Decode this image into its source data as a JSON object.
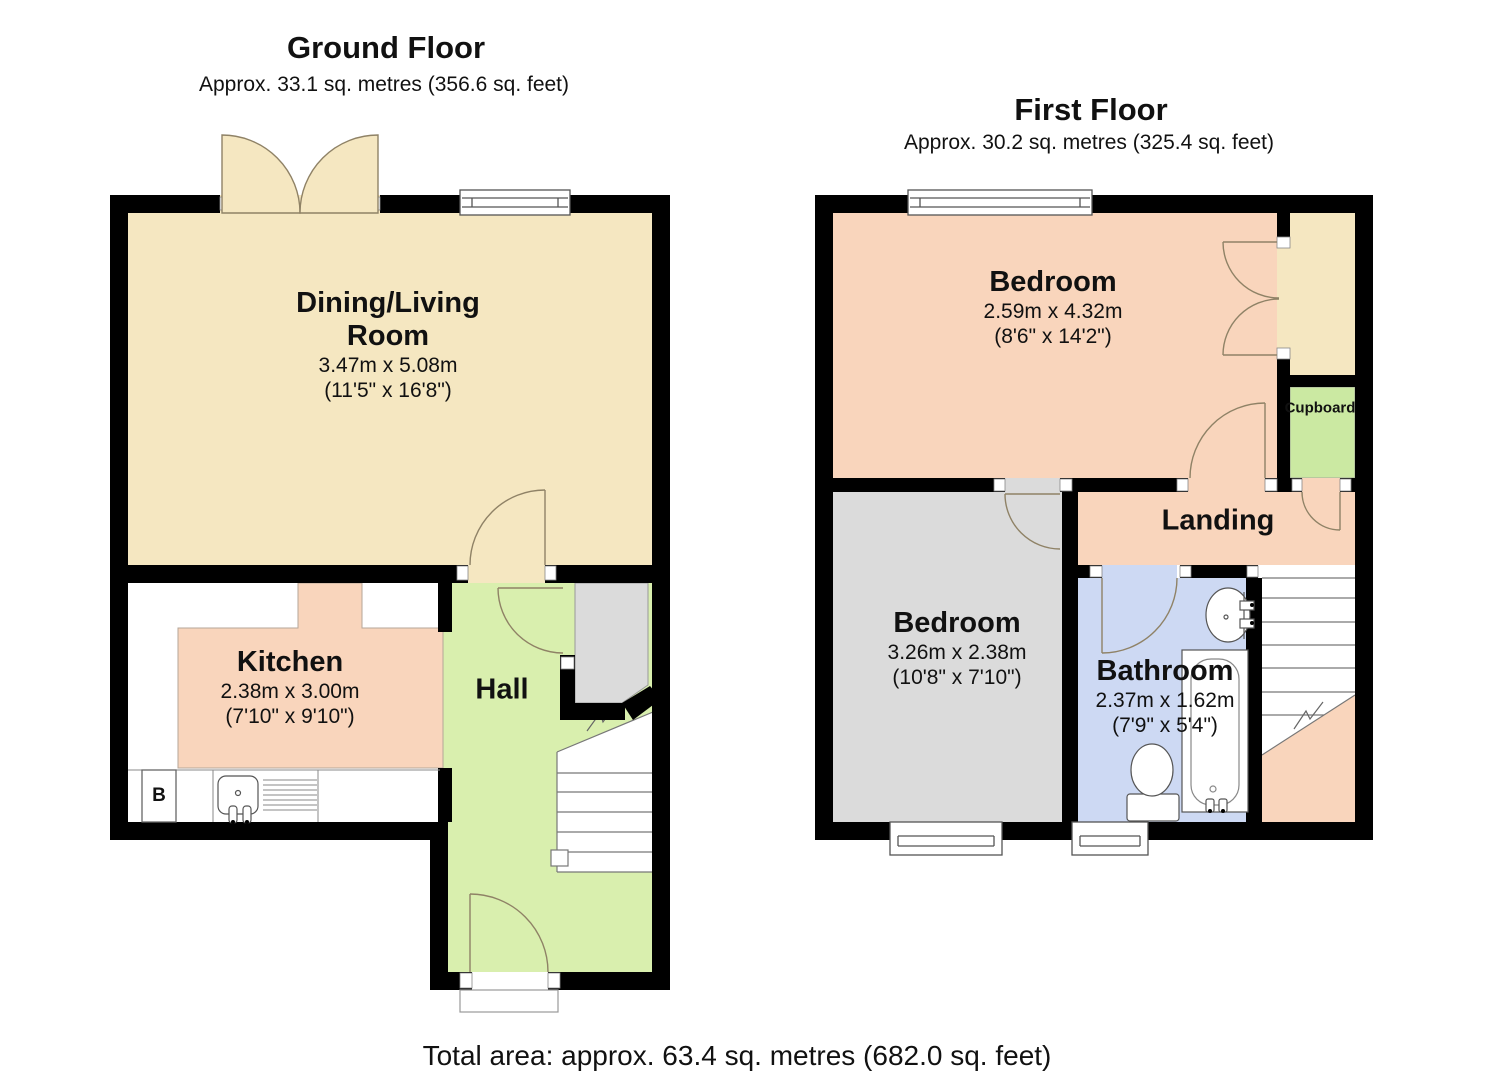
{
  "ground_floor": {
    "title": "Ground Floor",
    "subtitle": "Approx. 33.1 sq. metres (356.6 sq. feet)",
    "rooms": {
      "dining_living": {
        "name_line1": "Dining/Living",
        "name_line2": "Room",
        "dims_metric": "3.47m x 5.08m",
        "dims_imperial": "(11'5\" x 16'8\")"
      },
      "kitchen": {
        "name": "Kitchen",
        "dims_metric": "2.38m x 3.00m",
        "dims_imperial": "(7'10\" x 9'10\")"
      },
      "hall": {
        "name": "Hall"
      }
    },
    "boiler_label": "B"
  },
  "first_floor": {
    "title": "First Floor",
    "subtitle": "Approx. 30.2 sq. metres (325.4 sq. feet)",
    "rooms": {
      "bedroom1": {
        "name": "Bedroom",
        "dims_metric": "2.59m x 4.32m",
        "dims_imperial": "(8'6\" x 14'2\")"
      },
      "bedroom2": {
        "name": "Bedroom",
        "dims_metric": "3.26m x 2.38m",
        "dims_imperial": "(10'8\" x 7'10\")"
      },
      "bathroom": {
        "name": "Bathroom",
        "dims_metric": "2.37m x 1.62m",
        "dims_imperial": "(7'9\" x 5'4\")"
      },
      "landing": {
        "name": "Landing"
      },
      "cupboard": {
        "name": "Cupboard"
      }
    }
  },
  "footer": {
    "total_area": "Total area: approx. 63.4 sq. metres (682.0 sq. feet)"
  },
  "colors": {
    "wall": "#000000",
    "dining_cream": "#f5e7c1",
    "room_salmon": "#f9d5bc",
    "hall_green": "#d9efae",
    "cupboard_green": "#cbe9a2",
    "bedroom_grey": "#dbdbdb",
    "bathroom_blue": "#cdd9f3",
    "door_stroke": "#8f8266"
  }
}
